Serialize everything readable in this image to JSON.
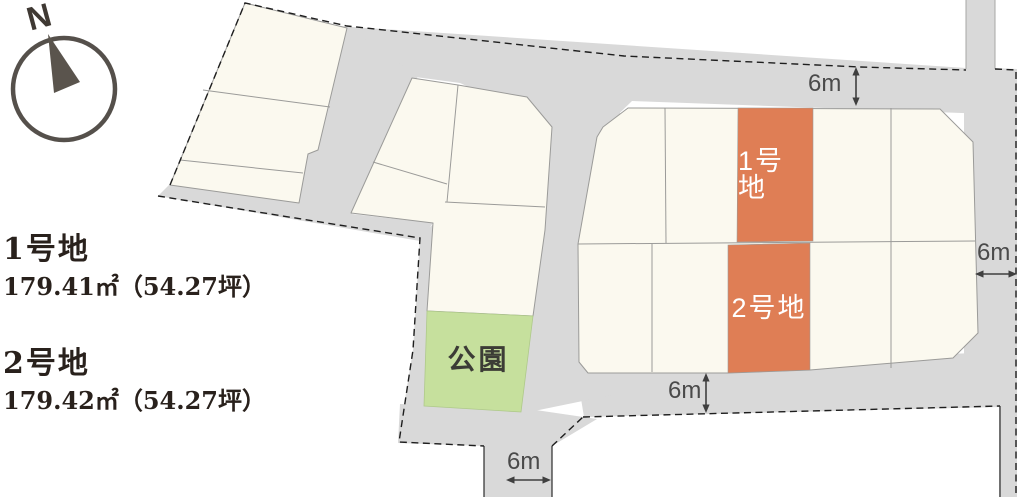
{
  "theme": {
    "road_gray": "#D9D9D9",
    "lot_cream": "#FBF9EF",
    "lot_border": "#9B9B99",
    "accent_orange": "#DF7E55",
    "park_green": "#C6E09D",
    "ink": "#29211C",
    "dim_text": "#4A4A4A",
    "compass_ink": "#55504B"
  },
  "compass": {
    "north_label": "N"
  },
  "legend": {
    "items": [
      {
        "name": "1号地",
        "area": "179.41㎡（54.27坪）"
      },
      {
        "name": "2号地",
        "area": "179.42㎡（54.27坪）"
      }
    ]
  },
  "map": {
    "highlight_lots": [
      {
        "label": "1号地"
      },
      {
        "label": "2号地"
      }
    ],
    "park": {
      "label": "公園"
    },
    "dimensions": [
      {
        "label": "6m",
        "position": "top-road"
      },
      {
        "label": "6m",
        "position": "right-road"
      },
      {
        "label": "6m",
        "position": "bottom-road"
      },
      {
        "label": "6m",
        "position": "southwest-road"
      }
    ]
  }
}
